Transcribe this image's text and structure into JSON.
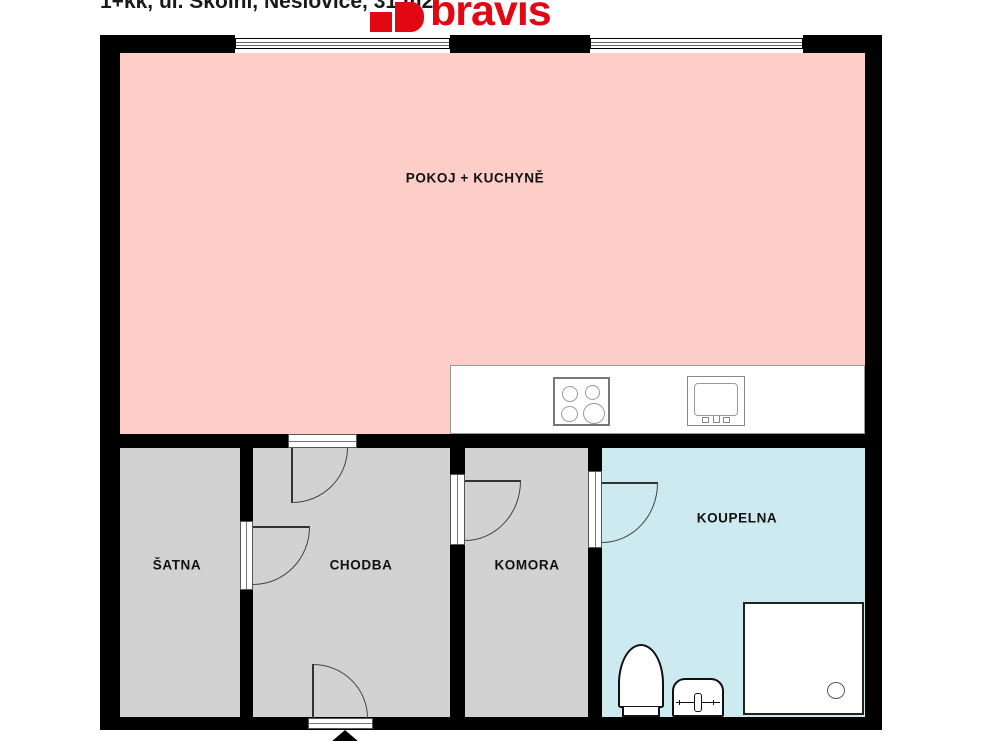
{
  "header": {
    "title": "1+kk, ul. Školní, Neslovice, 31 m2",
    "logo_text": "bravis"
  },
  "rooms": {
    "pokoj": {
      "label": "POKOJ + KUCHYNĚ",
      "fill": "pink"
    },
    "satna": {
      "label": "ŠATNA",
      "fill": "gray"
    },
    "chodba": {
      "label": "CHODBA",
      "fill": "gray"
    },
    "komora": {
      "label": "KOMORA",
      "fill": "gray"
    },
    "koupelna": {
      "label": "KOUPELNA",
      "fill": "blue"
    }
  },
  "fixtures": {
    "kitchen": [
      "stove-icon",
      "kitchen-sink-icon"
    ],
    "bathroom": [
      "toilet-icon",
      "washbasin-icon",
      "shower-icon"
    ],
    "openings": [
      "window-icon",
      "door-icon",
      "entrance-arrow-icon"
    ]
  },
  "colors": {
    "wall": "#000000",
    "room-pink": "#fdcdc8",
    "room-gray": "#d2d2d2",
    "room-blue": "#cdeaf0",
    "brand-red": "#e30613",
    "line": "#3a3a3a"
  }
}
